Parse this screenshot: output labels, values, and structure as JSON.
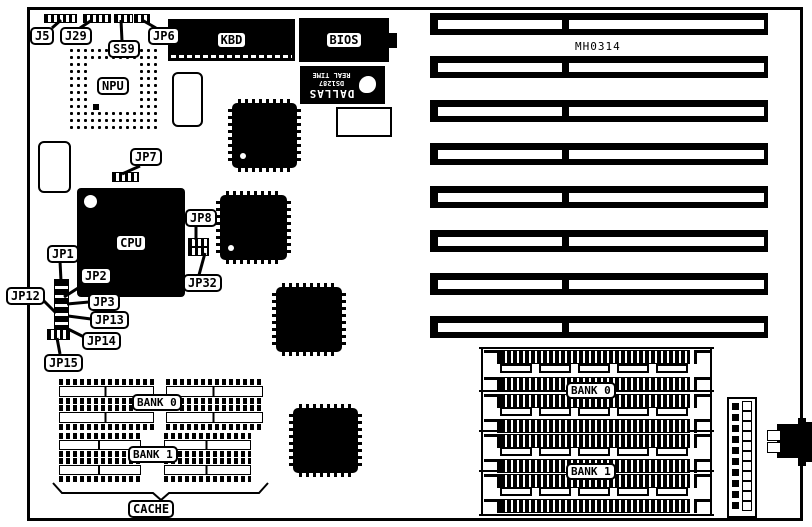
{
  "board": {
    "part_number": "MH0314"
  },
  "chips": {
    "npu": "NPU",
    "cpu": "CPU",
    "kbd": "KBD",
    "bios": "BIOS"
  },
  "rtc": {
    "brand": "DALLAS",
    "model": "DS1287",
    "line": "REAL TIME"
  },
  "callouts": {
    "j5": "J5",
    "j29": "J29",
    "s59": "S59",
    "jp6": "JP6",
    "jp7": "JP7",
    "jp1": "JP1",
    "jp2": "JP2",
    "jp12": "JP12",
    "jp3": "JP3",
    "jp13": "JP13",
    "jp14": "JP14",
    "jp15": "JP15",
    "jp8": "JP8",
    "jp32": "JP32"
  },
  "cache": {
    "bank0": "BANK 0",
    "bank1": "BANK 1",
    "label": "CACHE"
  },
  "simm": {
    "bank0": "BANK 0",
    "bank1": "BANK 1"
  },
  "counts": {
    "isa_slots": 8,
    "simm_sockets": 8,
    "cache_sockets": 8,
    "power_pins": 10
  }
}
